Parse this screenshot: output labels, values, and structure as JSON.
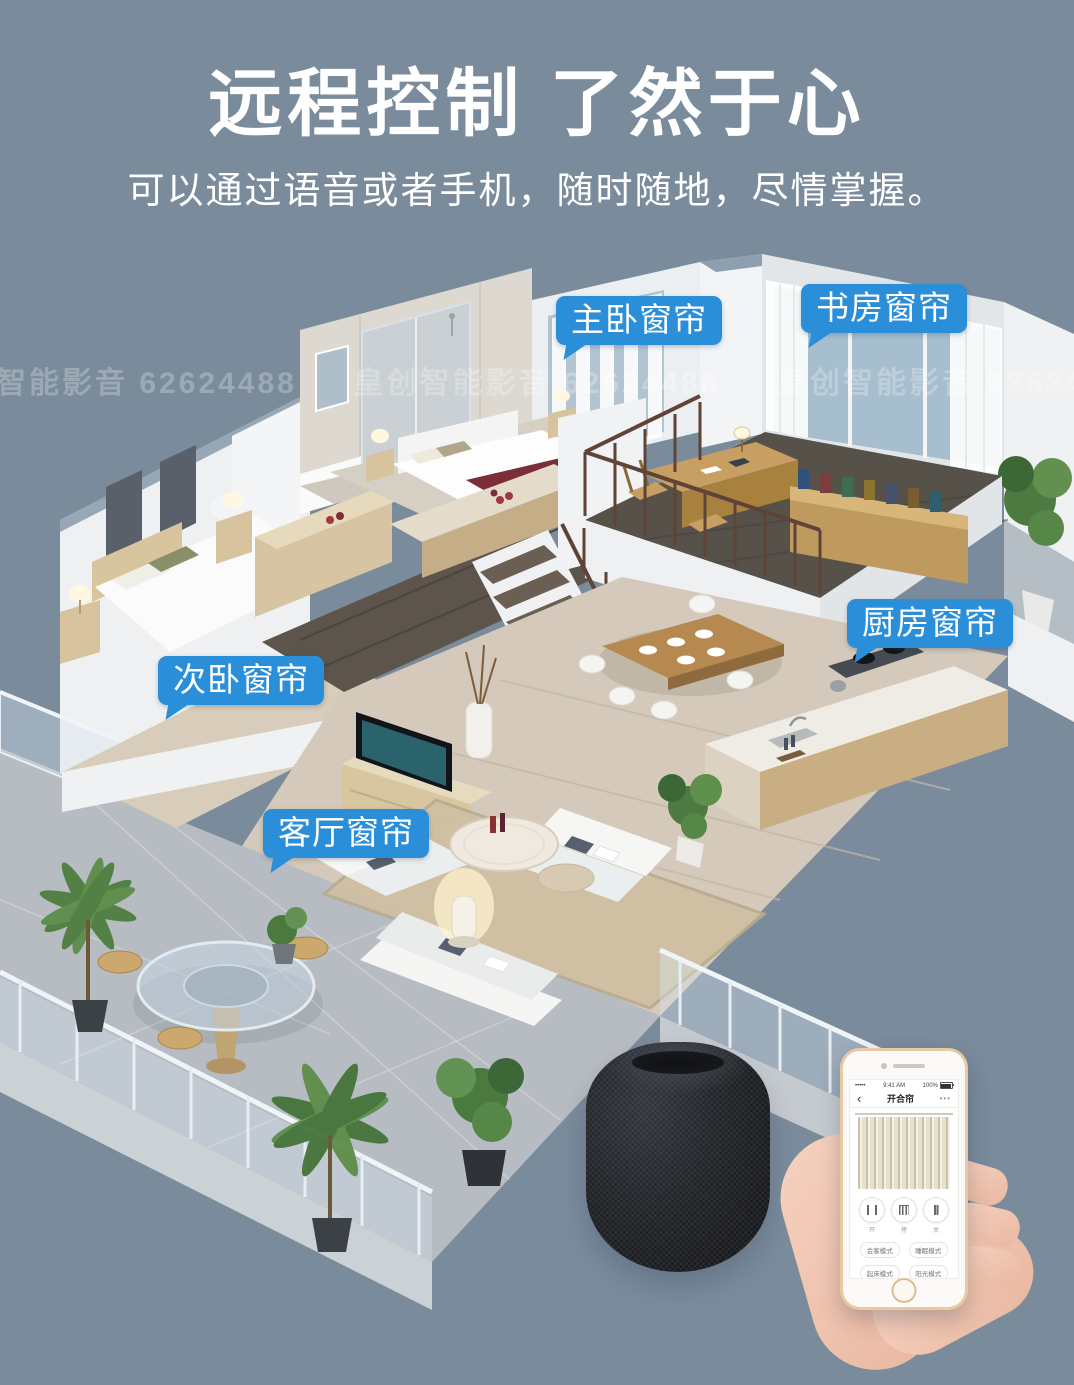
{
  "poster": {
    "title": "远程控制 了然于心",
    "subtitle": "可以通过语音或者手机，随时随地，尽情掌握。",
    "background_color": "#7a8b9c",
    "accent_color": "#2a8ed8",
    "text_color": "#ffffff"
  },
  "watermark": {
    "text": "皇创智能影音 62624488"
  },
  "callouts": [
    {
      "id": "master-bedroom",
      "text": "主卧窗帘"
    },
    {
      "id": "study",
      "text": "书房窗帘"
    },
    {
      "id": "kitchen",
      "text": "厨房窗帘"
    },
    {
      "id": "second-bedroom",
      "text": "次卧窗帘"
    },
    {
      "id": "living-room",
      "text": "客厅窗帘"
    }
  ],
  "devices": {
    "speaker": {
      "name": "smart-speaker"
    },
    "phone_app": {
      "status_bar": {
        "signal": "•••••",
        "time": "9:41 AM",
        "battery": "100%"
      },
      "nav": {
        "back": "‹",
        "title": "开合帘",
        "more": "•••"
      },
      "controls": [
        {
          "icon": "curtain-open-icon",
          "label": "开"
        },
        {
          "icon": "curtain-pause-icon",
          "label": "停"
        },
        {
          "icon": "curtain-close-icon",
          "label": "关"
        }
      ],
      "modes": [
        "会客模式",
        "睡眠模式",
        "起床模式",
        "阳光模式"
      ]
    }
  }
}
